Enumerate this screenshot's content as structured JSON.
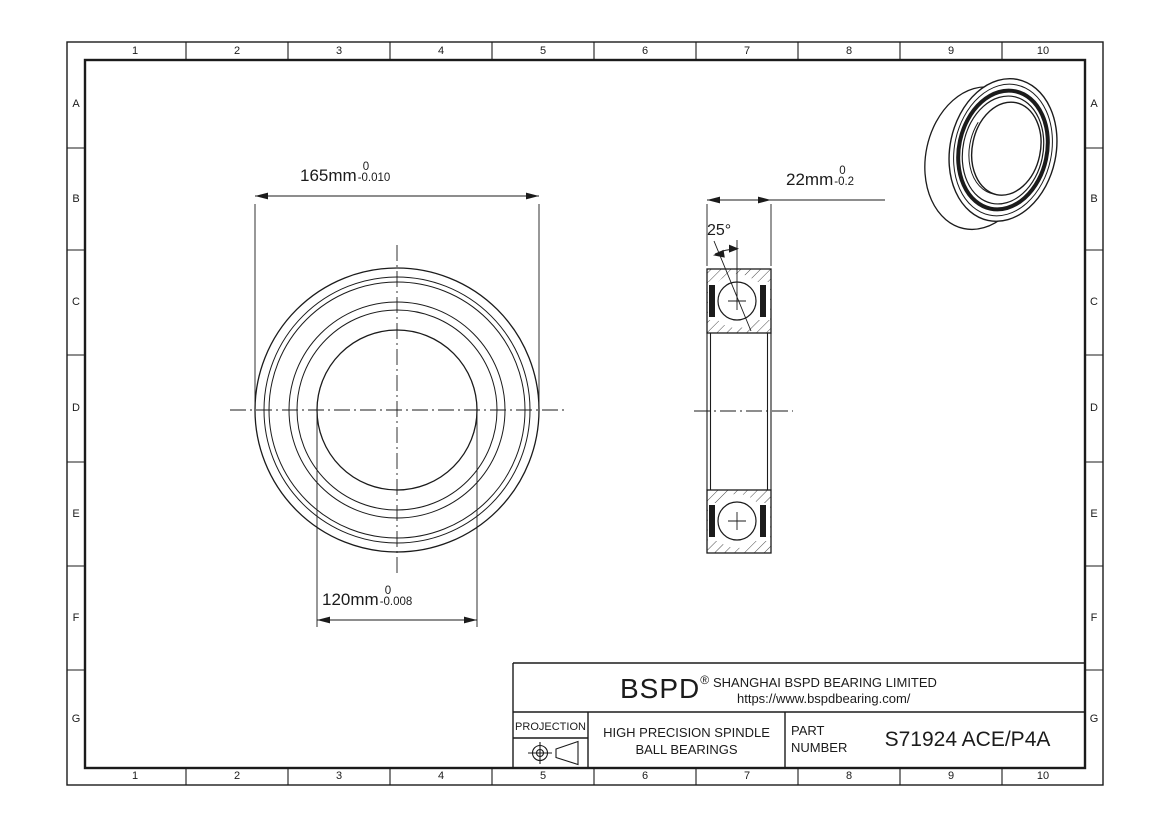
{
  "grid": {
    "columns": [
      "1",
      "2",
      "3",
      "4",
      "5",
      "6",
      "7",
      "8",
      "9",
      "10"
    ],
    "rows": [
      "A",
      "B",
      "C",
      "D",
      "E",
      "F",
      "G"
    ]
  },
  "drawing": {
    "dim_outer_diameter": {
      "value": "165mm",
      "tol_upper": "0",
      "tol_lower": "-0.010"
    },
    "dim_bore_diameter": {
      "value": "120mm",
      "tol_upper": "0",
      "tol_lower": "-0.008"
    },
    "dim_width": {
      "value": "22mm",
      "tol_upper": "0",
      "tol_lower": "-0.2"
    },
    "contact_angle": "25°"
  },
  "title_block": {
    "logo": "BSPD",
    "logo_mark": "®",
    "company": "SHANGHAI BSPD BEARING LIMITED",
    "website": "https://www.bspdbearing.com/",
    "projection_label": "PROJECTION",
    "product": "HIGH  PRECISION SPINDLE\nBALL BEARINGS",
    "part_label_line1": "PART",
    "part_label_line2": "NUMBER",
    "part_number": "S71924 ACE/P4A"
  },
  "colors": {
    "line": "#1b1b1b",
    "background": "#ffffff"
  }
}
